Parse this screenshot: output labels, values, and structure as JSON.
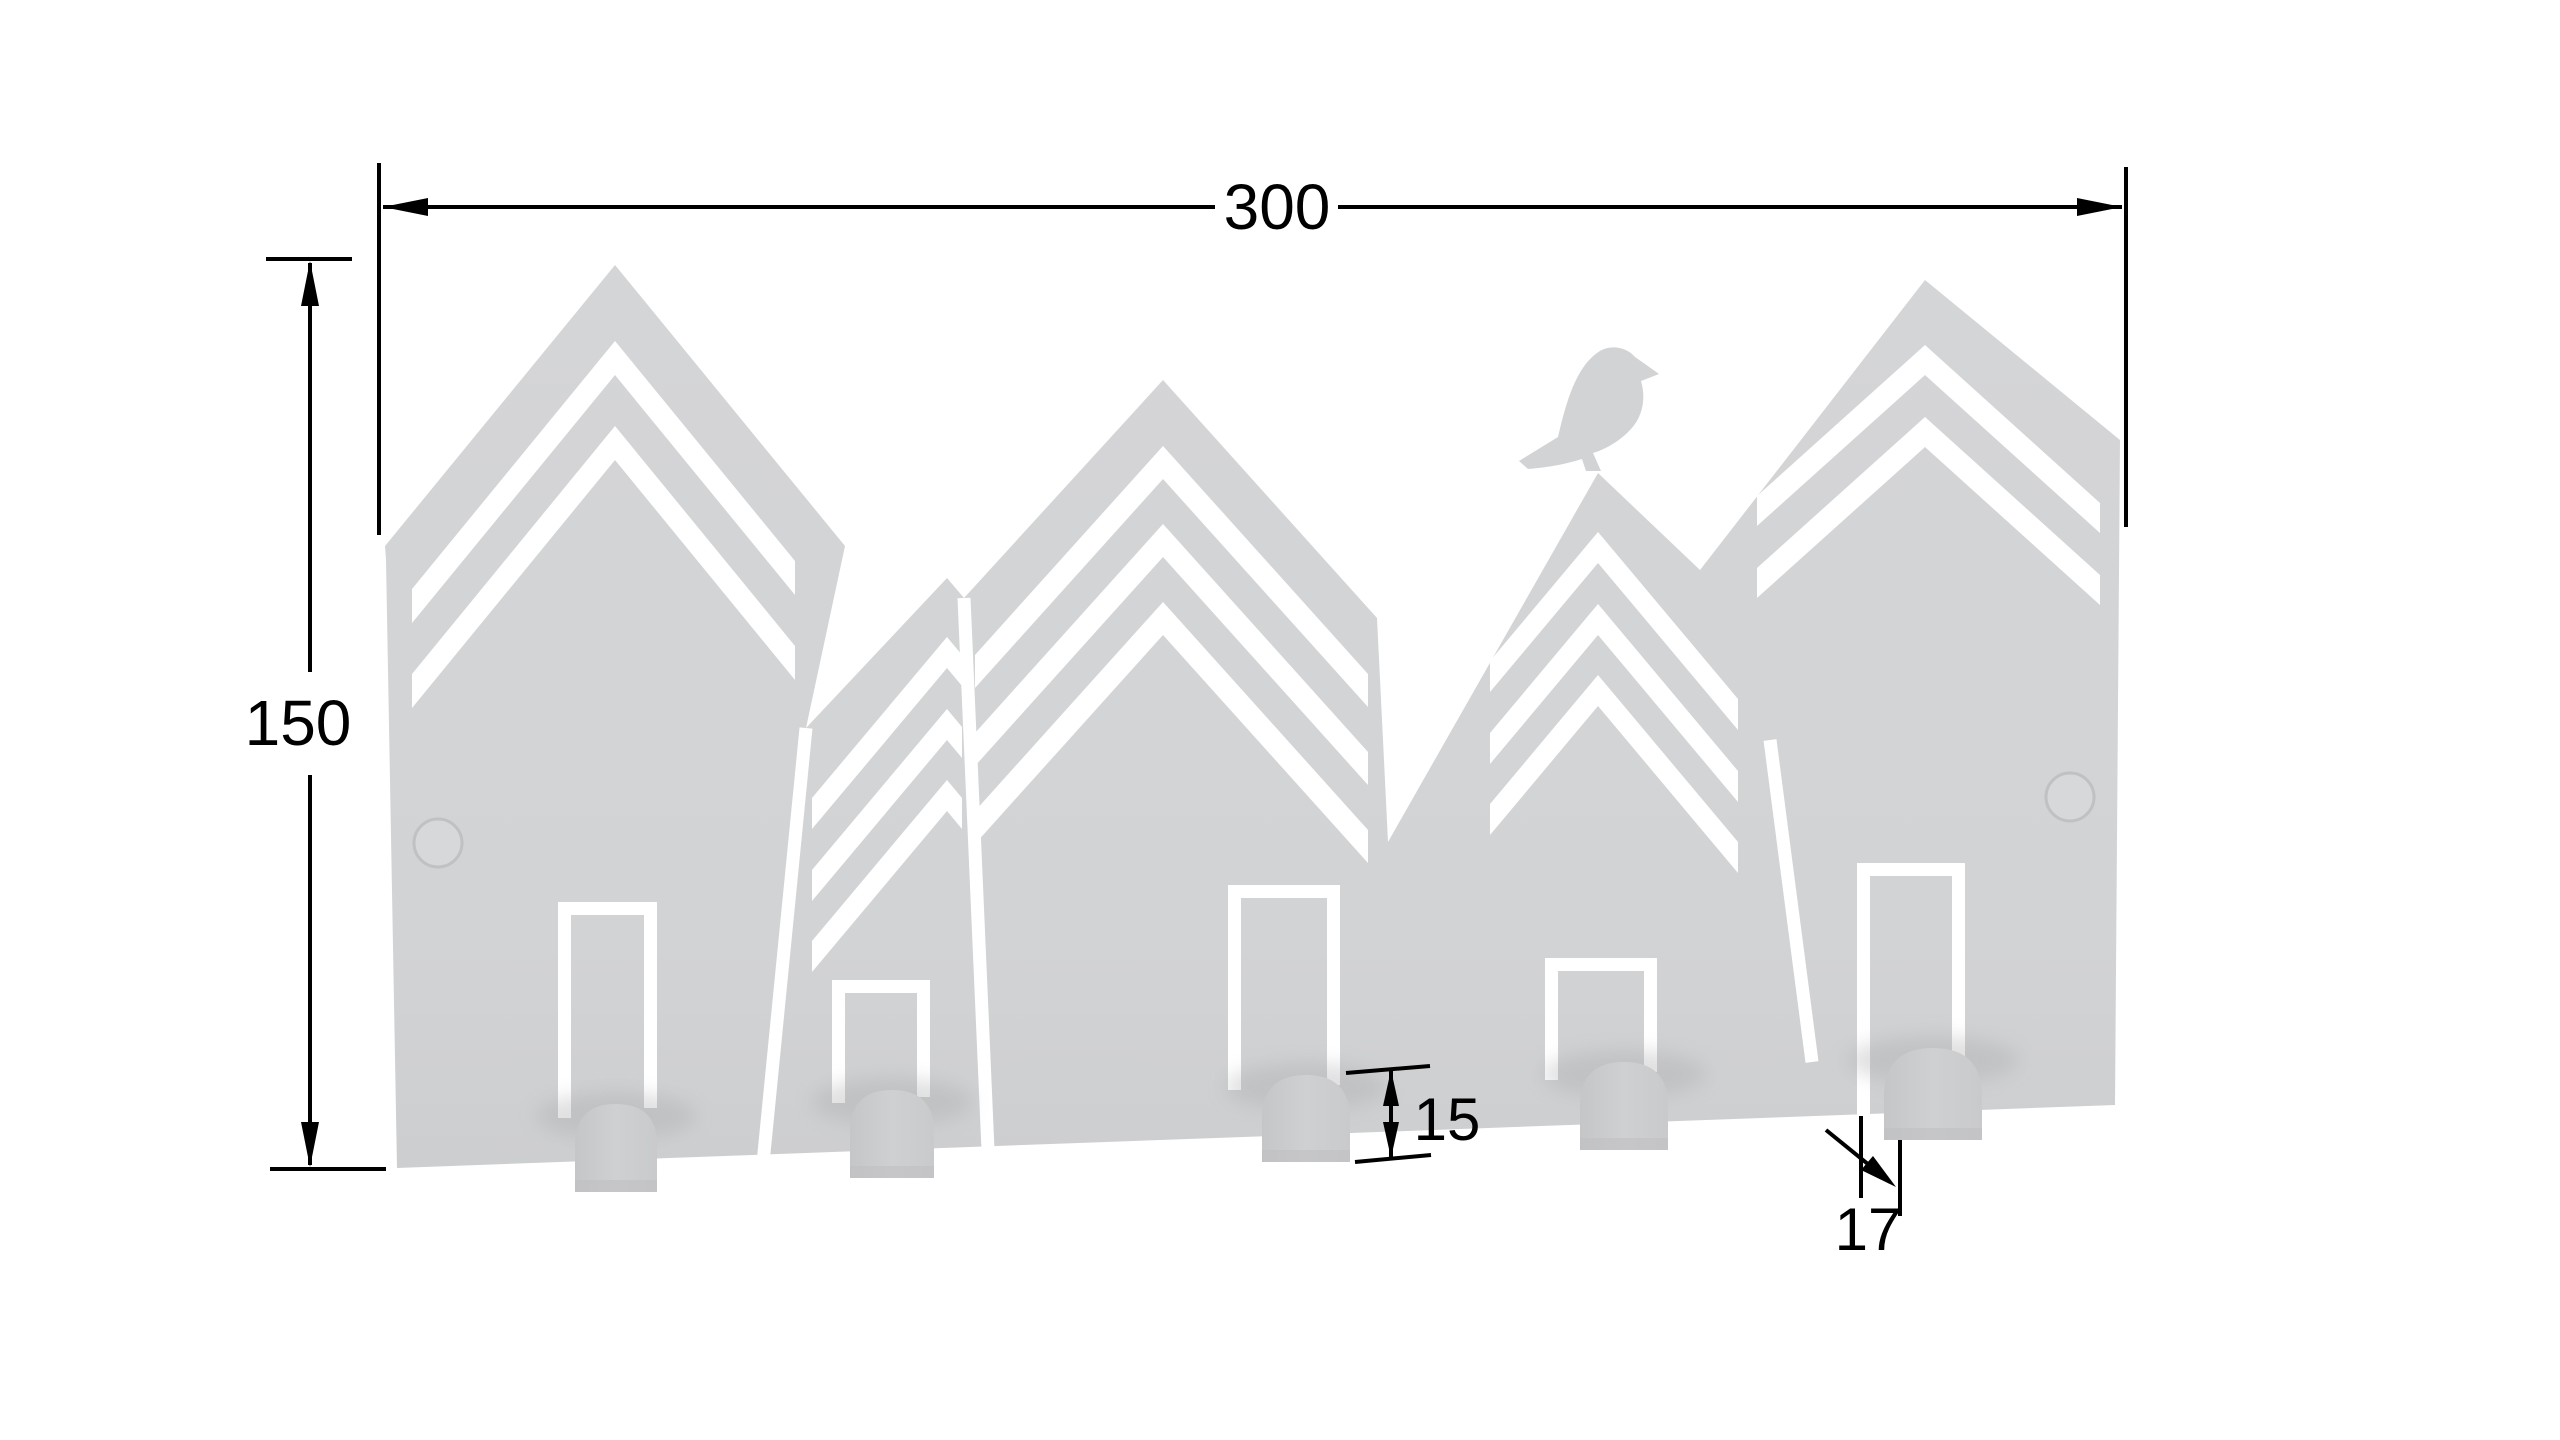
{
  "drawing": {
    "type": "technical drawing",
    "subject": "house-shaped wall coat rack with bird silhouette",
    "dimensions": {
      "width": {
        "label": "300"
      },
      "height": {
        "label": "150"
      },
      "hook_height": {
        "label": "15"
      },
      "hook_width": {
        "label": "17"
      }
    },
    "features": {
      "houses": 5,
      "doors": 5,
      "hooks": 5,
      "screw_holes": 2,
      "bird": "bird-icon",
      "roof_chevron_stripes": true
    }
  },
  "colors": {
    "background": "#ffffff",
    "panel_gray": "#d2d3d5",
    "panel_gray_dark": "#c9cacc",
    "hook_gray": "#cbccce",
    "shadow_gray": "#a8a9ab",
    "dimension_line": "#000000"
  }
}
